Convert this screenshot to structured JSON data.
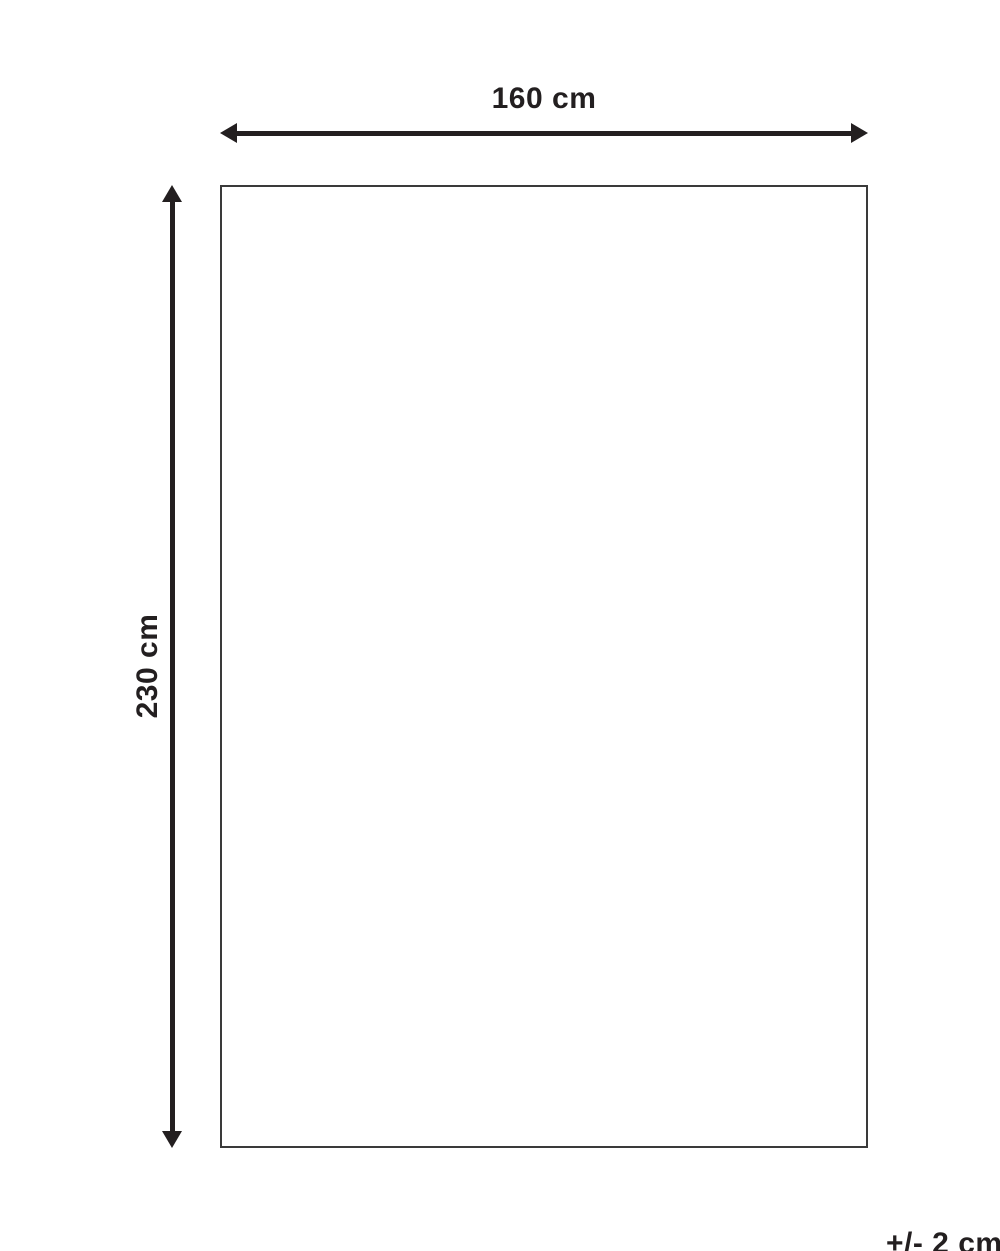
{
  "diagram": {
    "title": "product-dimension-diagram",
    "width_label": "160 cm",
    "height_label": "230 cm",
    "tolerance_label": "+/- 2 cm",
    "shape": "rectangle"
  },
  "colors": {
    "background": "#ffffff",
    "line": "#231f20",
    "rect_border": "#3a3a3a"
  }
}
